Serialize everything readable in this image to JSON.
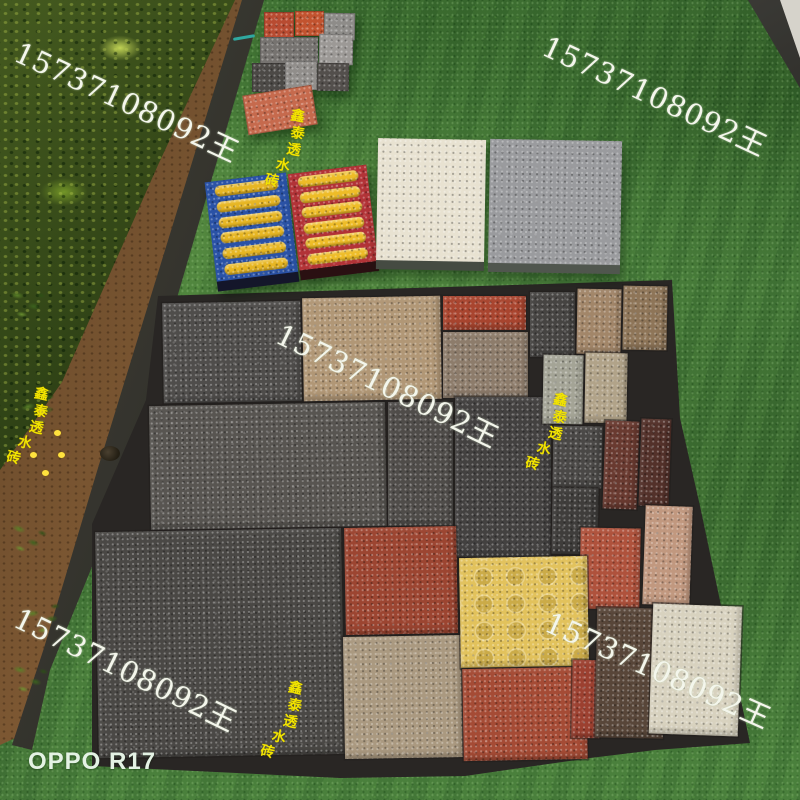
{
  "meta": {
    "camera_label": "OPPO R17"
  },
  "watermark": {
    "phone_text": "15737108092王",
    "cn_text": "鑫泰透水砖",
    "phone_instances": [
      {
        "x": 26,
        "y": 30,
        "rot": 25
      },
      {
        "x": 554,
        "y": 24,
        "rot": 25
      },
      {
        "x": 288,
        "y": 312,
        "rot": 26
      },
      {
        "x": 26,
        "y": 596,
        "rot": 26
      },
      {
        "x": 556,
        "y": 600,
        "rot": 24
      }
    ],
    "cn_instances": [
      {
        "x": 282,
        "y": 108,
        "rot": 10
      },
      {
        "x": 26,
        "y": 386,
        "rot": 12
      },
      {
        "x": 545,
        "y": 392,
        "rot": 12
      },
      {
        "x": 280,
        "y": 680,
        "rot": 12
      }
    ]
  },
  "scene": {
    "grass_base": "#497d3c",
    "soil_color": "#8a6138",
    "hedge_color": "#1d330f",
    "curb_color": "#26251f",
    "corner_concrete_color": "#d6d3cb"
  },
  "brick_cluster": {
    "x": 240,
    "y": 6,
    "bricks": [
      {
        "n": "red-brick-1",
        "x": 24,
        "y": 6,
        "w": 30,
        "h": 26,
        "c": "#b84b31",
        "r": 0
      },
      {
        "n": "red-brick-2",
        "x": 55,
        "y": 5,
        "w": 29,
        "h": 25,
        "c": "#c2532f",
        "r": 0
      },
      {
        "n": "gray-brick-1",
        "x": 84,
        "y": 7,
        "w": 31,
        "h": 27,
        "c": "#8e8c89",
        "r": 1
      },
      {
        "n": "gray-brick-wide",
        "x": 20,
        "y": 31,
        "w": 58,
        "h": 27,
        "c": "#767370",
        "r": 0
      },
      {
        "n": "light-gray-brick",
        "x": 79,
        "y": 28,
        "w": 34,
        "h": 31,
        "c": "#9c9996",
        "r": 1
      },
      {
        "n": "dark-brick-1",
        "x": 12,
        "y": 57,
        "w": 33,
        "h": 29,
        "c": "#4c4946",
        "r": 0
      },
      {
        "n": "light-gray-brick-2",
        "x": 45,
        "y": 55,
        "w": 32,
        "h": 29,
        "c": "#918e8b",
        "r": 0
      },
      {
        "n": "dark-brick-2",
        "x": 77,
        "y": 57,
        "w": 32,
        "h": 28,
        "c": "#534f4c",
        "r": 1
      },
      {
        "n": "salmon-brick",
        "x": 5,
        "y": 84,
        "w": 70,
        "h": 40,
        "c": "#c66a4d",
        "r": -9
      }
    ]
  },
  "tactile_plates": [
    {
      "n": "blue-tactile-plate",
      "x": 211,
      "y": 177,
      "w": 82,
      "h": 100,
      "rot": -7,
      "color": "#2a52a6",
      "edge": "#14162a",
      "bar_color": "#e7b623",
      "bars": 6
    },
    {
      "n": "red-tactile-plate",
      "x": 294,
      "y": 169,
      "w": 79,
      "h": 97,
      "rot": -7,
      "color": "#b23337",
      "edge": "#2a1012",
      "bar_color": "#eebc27",
      "bars": 6
    }
  ],
  "slabs": [
    {
      "n": "cream-slab",
      "x": 377,
      "y": 139,
      "w": 108,
      "h": 122,
      "rot": 1,
      "color": "#e8e2d1",
      "edge": "#454b42"
    },
    {
      "n": "gray-slab",
      "x": 489,
      "y": 140,
      "w": 132,
      "h": 124,
      "rot": 1,
      "color": "#9a9b9e",
      "edge": "#50564e"
    }
  ],
  "patchwork": {
    "backing_color": "#292624",
    "tiles": [
      {
        "n": "dark-gray-square",
        "x": 163,
        "y": 302,
        "w": 138,
        "h": 100,
        "c": "#4f4d4b",
        "r": -1
      },
      {
        "n": "tan-square",
        "x": 303,
        "y": 297,
        "w": 138,
        "h": 103,
        "c": "#b19776",
        "r": -1
      },
      {
        "n": "red-strip",
        "x": 443,
        "y": 296,
        "w": 83,
        "h": 34,
        "c": "#a9452f",
        "r": 0
      },
      {
        "n": "gray-brown-square",
        "x": 443,
        "y": 332,
        "w": 85,
        "h": 66,
        "c": "#8d7c6b",
        "r": 0
      },
      {
        "n": "dark-small-1",
        "x": 530,
        "y": 292,
        "w": 45,
        "h": 65,
        "c": "#464442",
        "r": 0
      },
      {
        "n": "light-brown-small",
        "x": 577,
        "y": 289,
        "w": 44,
        "h": 65,
        "c": "#a28669",
        "r": 1
      },
      {
        "n": "brown-small-edge",
        "x": 623,
        "y": 286,
        "w": 44,
        "h": 64,
        "c": "#8e7558",
        "r": 1
      },
      {
        "n": "wide-dark-rect",
        "x": 150,
        "y": 404,
        "w": 236,
        "h": 124,
        "c": "#585551",
        "r": -1
      },
      {
        "n": "mid-dark-rect",
        "x": 388,
        "y": 402,
        "w": 65,
        "h": 124,
        "c": "#4f4c49",
        "r": 0
      },
      {
        "n": "tall-dark-rect",
        "x": 455,
        "y": 397,
        "w": 96,
        "h": 160,
        "c": "#434140",
        "r": 0
      },
      {
        "n": "sage-small",
        "x": 543,
        "y": 355,
        "w": 40,
        "h": 69,
        "c": "#a4a496",
        "r": 1
      },
      {
        "n": "light-tan-small",
        "x": 585,
        "y": 353,
        "w": 42,
        "h": 70,
        "c": "#b1a389",
        "r": 1
      },
      {
        "n": "dark-small-2",
        "x": 553,
        "y": 426,
        "w": 49,
        "h": 62,
        "c": "#4a4846",
        "r": 1
      },
      {
        "n": "maroon-small",
        "x": 604,
        "y": 421,
        "w": 34,
        "h": 88,
        "c": "#693a30",
        "r": 2
      },
      {
        "n": "dark-brown-edge",
        "x": 640,
        "y": 419,
        "w": 30,
        "h": 87,
        "c": "#53312a",
        "r": 2
      },
      {
        "n": "dark-small-3",
        "x": 552,
        "y": 488,
        "w": 46,
        "h": 66,
        "c": "#3f3d3b",
        "r": 1
      },
      {
        "n": "big-dark-square",
        "x": 97,
        "y": 530,
        "w": 246,
        "h": 226,
        "c": "#4a4845",
        "r": -1
      },
      {
        "n": "red-square",
        "x": 345,
        "y": 527,
        "w": 112,
        "h": 107,
        "c": "#9c4531",
        "r": -1
      },
      {
        "n": "tan-bottom",
        "x": 344,
        "y": 636,
        "w": 118,
        "h": 122,
        "c": "#aa9980",
        "r": -1
      },
      {
        "n": "red-orange-small",
        "x": 580,
        "y": 528,
        "w": 60,
        "h": 81,
        "c": "#af523c",
        "r": 1
      },
      {
        "n": "pink-small",
        "x": 644,
        "y": 506,
        "w": 47,
        "h": 99,
        "c": "#c1987f",
        "r": 2
      },
      {
        "n": "yellow-tactile",
        "x": 460,
        "y": 557,
        "w": 128,
        "h": 110,
        "c": "#e2c25c",
        "r": -1,
        "dots": true
      },
      {
        "n": "red-wide-bottom",
        "x": 463,
        "y": 668,
        "w": 124,
        "h": 92,
        "c": "#a54b35",
        "r": -1
      },
      {
        "n": "red-vert-small",
        "x": 572,
        "y": 660,
        "w": 28,
        "h": 78,
        "c": "#9c4030",
        "r": 1
      },
      {
        "n": "dark-brown-bottom",
        "x": 596,
        "y": 608,
        "w": 68,
        "h": 130,
        "c": "#584639",
        "r": 1
      },
      {
        "n": "cream-bottom",
        "x": 651,
        "y": 605,
        "w": 89,
        "h": 130,
        "c": "#d8d2bf",
        "r": 2
      }
    ]
  },
  "garden": {
    "sprigs": [
      {
        "x": 0,
        "y": 285,
        "r": 10
      },
      {
        "x": 14,
        "y": 392,
        "r": -14
      },
      {
        "x": 0,
        "y": 520,
        "r": 20
      },
      {
        "x": 18,
        "y": 600,
        "r": -8
      },
      {
        "x": 2,
        "y": 660,
        "r": 14
      }
    ],
    "flowers": [
      {
        "x": 38,
        "y": 408
      },
      {
        "x": 54,
        "y": 430
      },
      {
        "x": 30,
        "y": 452
      },
      {
        "x": 58,
        "y": 452
      },
      {
        "x": 42,
        "y": 470
      }
    ]
  }
}
